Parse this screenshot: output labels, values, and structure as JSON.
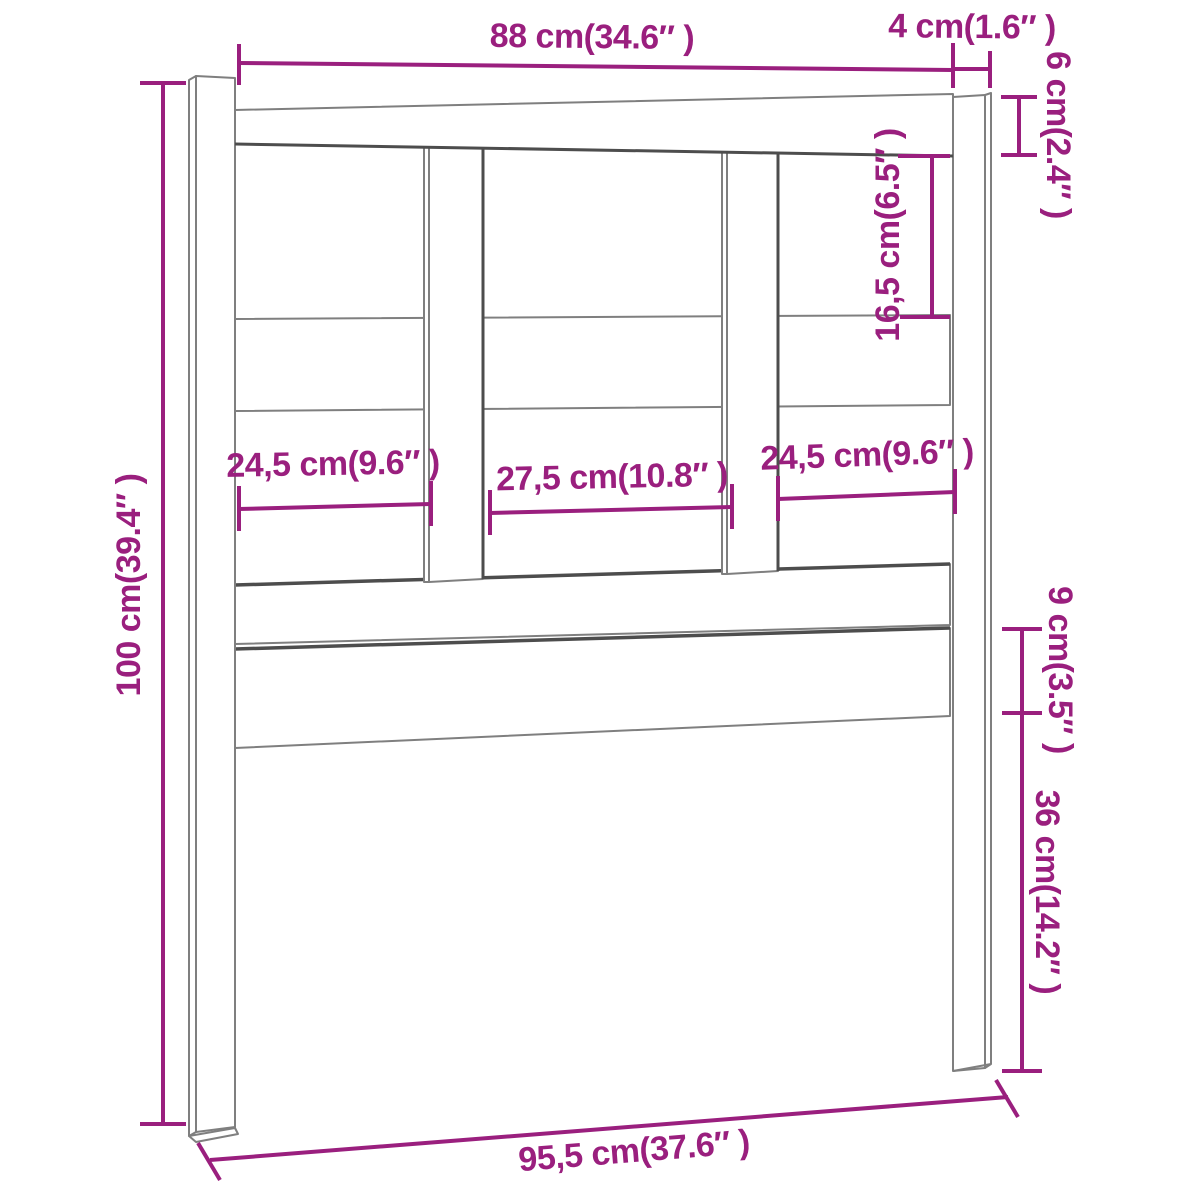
{
  "diagram": {
    "subject": "Bed headboard technical dimension drawing",
    "colors": {
      "dimension_annotation": "#9A1F7E",
      "drawing_line": "#7F7F7F",
      "shadow_line": "#4D4D4D",
      "background": "#FFFFFF"
    },
    "dimensions": {
      "top_width": "88 cm(34.6″ )",
      "right_post_width": "4 cm(1.6″ )",
      "top_rail_height": "6 cm(2.4″ )",
      "upper_opening_height": "16,5 cm(6.5″ )",
      "total_height": "100 cm(39.4″ )",
      "left_opening_width": "24,5 cm(9.6″ )",
      "center_opening_width": "27,5 cm(10.8″ )",
      "right_opening_width": "24,5 cm(9.6″ )",
      "bottom_board_height": "9 cm(3.5″ )",
      "bottom_clearance_height": "36 cm(14.2″ )",
      "total_width": "95,5 cm(37.6″ )"
    }
  }
}
